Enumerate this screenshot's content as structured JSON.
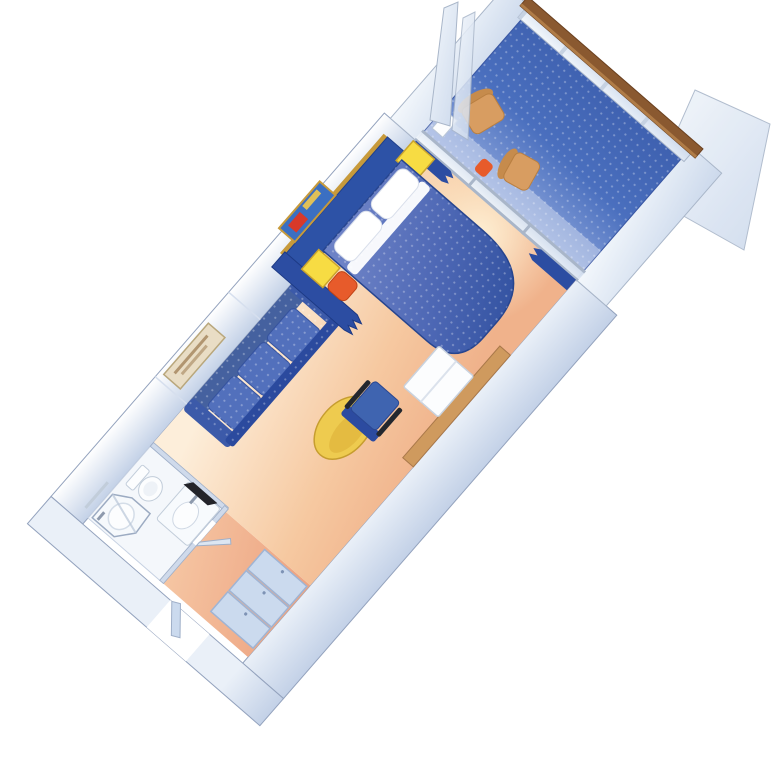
{
  "image": {
    "title": "Balcony stateroom - 3D cutaway floor plan",
    "description": "Isometric cutaway illustration of a cruise-ship balcony stateroom: entry corridor with wardrobe, bathroom with shower, toilet and sink, sitting area with sofa, coffee table and desk, sleeping area with queen bed, nightstands and divider curtain, and a private balcony with deck chairs behind a sliding glass door and glass balustrade with wood rail."
  },
  "rooms": [
    {
      "id": "balcony",
      "label": "Balcony"
    },
    {
      "id": "sleeping-area",
      "label": "Sleeping area"
    },
    {
      "id": "sitting-area",
      "label": "Sitting area"
    },
    {
      "id": "bathroom",
      "label": "Bathroom"
    },
    {
      "id": "entry-corridor",
      "label": "Entry corridor"
    }
  ],
  "furniture": [
    "queen-bed",
    "pillows",
    "nightstands",
    "orange-cushions",
    "headboard-panel",
    "wall-art-above-bed",
    "wall-art-above-sofa",
    "sofa",
    "coffee-table",
    "desk-chair",
    "vanity-desk",
    "white-cabinet",
    "divider-curtain",
    "window-curtains",
    "sliding-glass-door",
    "wardrobe-closet",
    "shower",
    "toilet",
    "sink-vanity",
    "mirror",
    "towel-bar",
    "entry-door",
    "balcony-chairs",
    "balcony-table",
    "glass-balustrade",
    "wood-cap-rail",
    "privacy-partitions"
  ],
  "colors": {
    "background": "#ffffff",
    "outline": "#93a2bd",
    "wall_light": "#ffffff",
    "wall_mid": "#eaf0f8",
    "wall_deep": "#c3d1e7",
    "glass_light": "#f4f8fc",
    "glass_deep": "#ccd9ec",
    "frame_metal": "#a9b6c9",
    "floor_light": "#fdeeda",
    "floor_warm": "#f6c9a1",
    "floor_deep": "#f0b28b",
    "corridor_light": "#f6c7a4",
    "corridor_deep": "#eda583",
    "glow": "#fff3d8",
    "deck_light": "#8aa3da",
    "deck_blue": "#4a6fbe",
    "deck_deep": "#3d5fae",
    "bed_light": "#6d82c6",
    "bed_mid": "#4e68b5",
    "bed_dark": "#30509f",
    "pillow_white": "#ffffff",
    "headboard_blue": "#2d52a6",
    "gold_trim": "#c79a3b",
    "sofa_blue": "#5270bc",
    "sofa_back": "#45619f",
    "sofa_dark": "#2b4a9e",
    "curtain_blue": "#2c4da2",
    "nightstand_yellow": "#f7dc43",
    "cushion_orange": "#e75b2b",
    "table_yellow": "#eecb4f",
    "chair_blue": "#3f64b0",
    "chair_back_blue": "#2c4ba0",
    "chair_arm_dark": "#23272e",
    "desk_wood": "#cf9a5e",
    "rail_wood": "#8a5930",
    "patio_chair_tan": "#d89d61",
    "patio_chair_shade": "#c68b4c",
    "fixture_white": "#fcfdfe",
    "fixture_line": "#c2cdda",
    "closet_blue": "#cbdaee",
    "mirror_dark": "#23242a",
    "picture_sea": "#3b6fc2",
    "picture_red": "#d8392a",
    "picture_gold": "#f2c94c",
    "picture_sand": "#e9ddc5",
    "picture_sand_stroke": "#a3835a"
  }
}
